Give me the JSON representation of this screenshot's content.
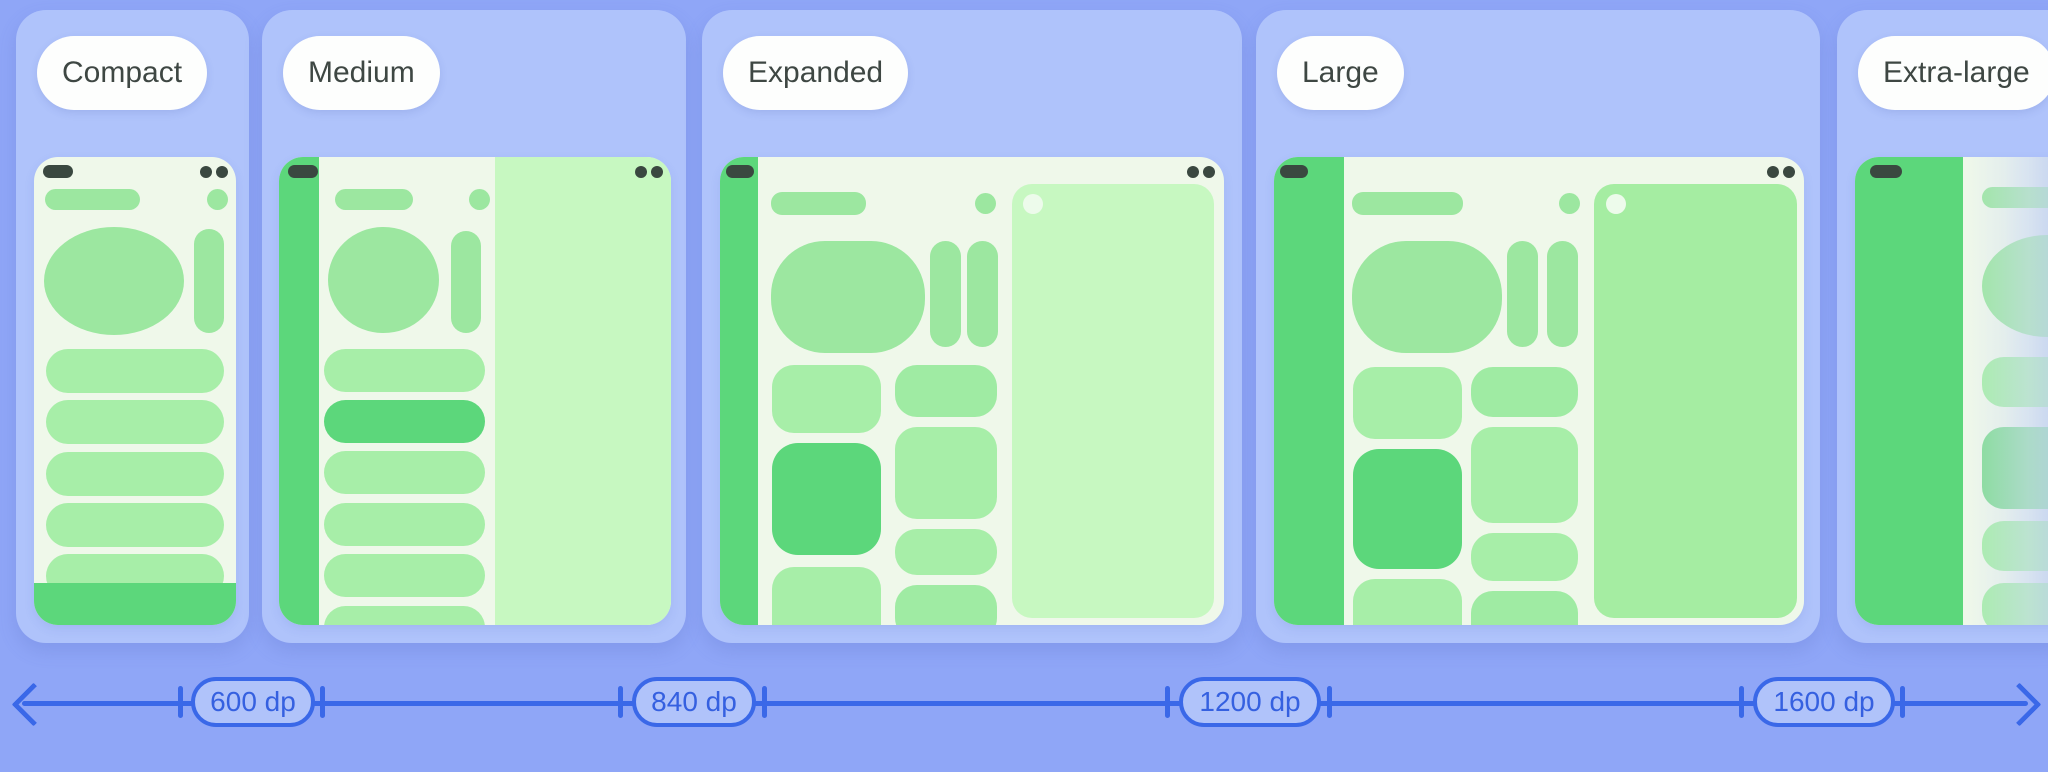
{
  "size_classes": [
    {
      "label": "Compact"
    },
    {
      "label": "Medium"
    },
    {
      "label": "Expanded"
    },
    {
      "label": "Large"
    },
    {
      "label": "Extra-large"
    }
  ],
  "ruler": {
    "breakpoints": [
      {
        "label": "600 dp"
      },
      {
        "label": "840 dp"
      },
      {
        "label": "1200 dp"
      },
      {
        "label": "1600 dp"
      }
    ]
  },
  "colors": {
    "page_background": "#8FA6F7",
    "card_background": "#AFC3FB",
    "chip_background": "#FDFEFD",
    "chip_text": "#3E4743",
    "screen_background": "#EFF8EA",
    "green_strong": "#5CD77B",
    "green_mid": "#9CE7A0",
    "green_light": "#A7EEA8",
    "detail_pane_light": "#C7F8C1",
    "detail_pane_mid": "#A5EDA2",
    "status_ink": "#3A4840",
    "ruler_blue": "#3A68E8",
    "badge_fill": "#B0C3FA",
    "badge_text": "#3560E0"
  }
}
